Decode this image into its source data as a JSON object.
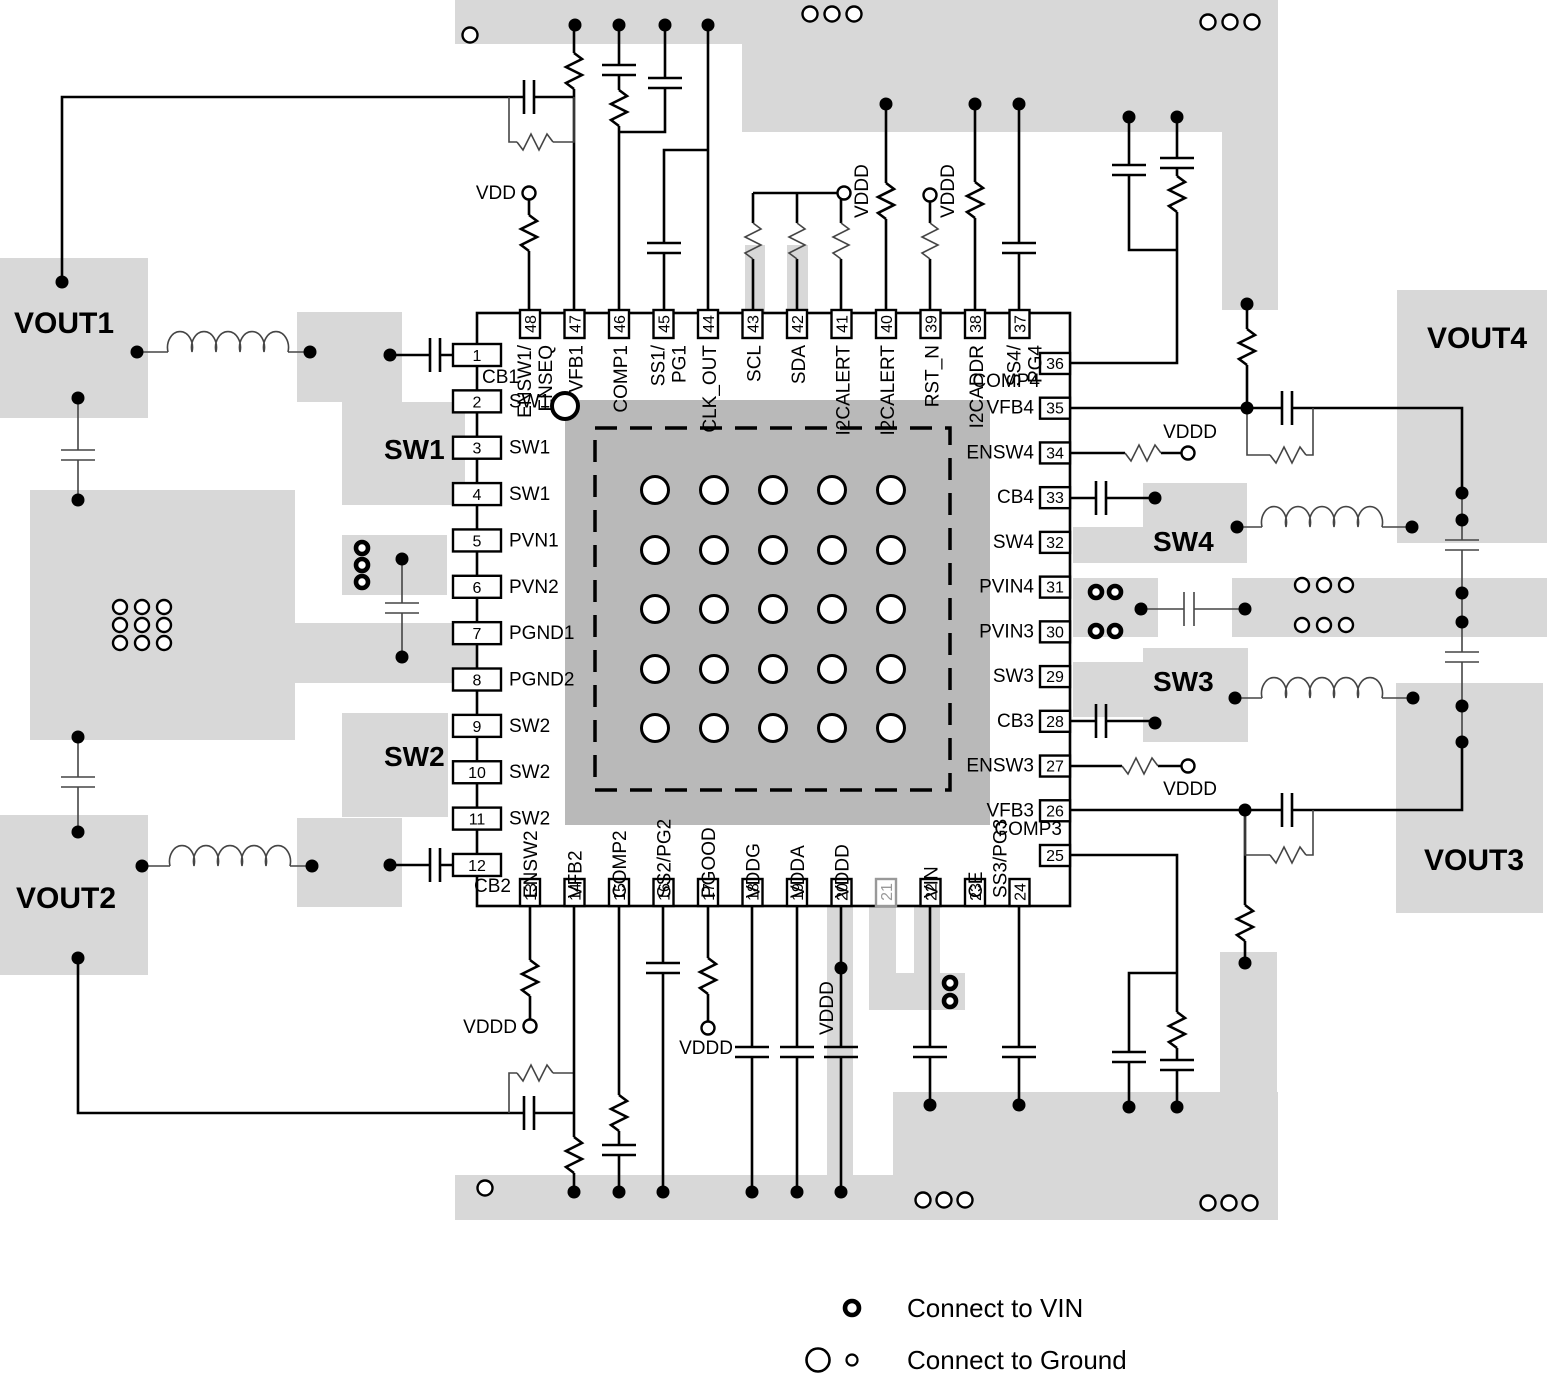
{
  "diagram_title": "PCB layout recommendation for 48-pin quad-output converter",
  "power_labels": {
    "vdd": "VDD",
    "vddd": "VDDD"
  },
  "region_labels": {
    "vout1": "VOUT1",
    "vout2": "VOUT2",
    "vout3": "VOUT3",
    "vout4": "VOUT4",
    "sw1": "SW1",
    "sw2": "SW2",
    "sw3": "SW3",
    "sw4": "SW4"
  },
  "legend": {
    "vin_label": "Connect to VIN",
    "ground_label": "Connect to Ground"
  },
  "chip": {
    "pins": [
      {
        "num": "1",
        "name": "CB1",
        "side": "left"
      },
      {
        "num": "2",
        "name": "SW1",
        "side": "left"
      },
      {
        "num": "3",
        "name": "SW1",
        "side": "left"
      },
      {
        "num": "4",
        "name": "SW1",
        "side": "left"
      },
      {
        "num": "5",
        "name": "PVN1",
        "side": "left"
      },
      {
        "num": "6",
        "name": "PVN2",
        "side": "left"
      },
      {
        "num": "7",
        "name": "PGND1",
        "side": "left"
      },
      {
        "num": "8",
        "name": "PGND2",
        "side": "left"
      },
      {
        "num": "9",
        "name": "SW2",
        "side": "left"
      },
      {
        "num": "10",
        "name": "SW2",
        "side": "left"
      },
      {
        "num": "11",
        "name": "SW2",
        "side": "left"
      },
      {
        "num": "12",
        "name": "CB2",
        "side": "left"
      },
      {
        "num": "13",
        "name": "ENSW2",
        "side": "bottom"
      },
      {
        "num": "14",
        "name": "VFB2",
        "side": "bottom"
      },
      {
        "num": "15",
        "name": "COMP2",
        "side": "bottom"
      },
      {
        "num": "16",
        "name": "SS2/PG2",
        "side": "bottom"
      },
      {
        "num": "17",
        "name": "PGOOD",
        "side": "bottom"
      },
      {
        "num": "18",
        "name": "VDDG",
        "side": "bottom"
      },
      {
        "num": "19",
        "name": "VDDA",
        "side": "bottom"
      },
      {
        "num": "20",
        "name": "VDDD",
        "side": "bottom"
      },
      {
        "num": "21",
        "name": "",
        "side": "bottom",
        "muted": true
      },
      {
        "num": "22",
        "name": "VIN",
        "side": "bottom"
      },
      {
        "num": "23",
        "name": "CE",
        "side": "bottom"
      },
      {
        "num": "24",
        "name": "SS3/PG3",
        "side": "bottom"
      },
      {
        "num": "25",
        "name": "COMP3",
        "side": "right"
      },
      {
        "num": "26",
        "name": "VFB3",
        "side": "right"
      },
      {
        "num": "27",
        "name": "ENSW3",
        "side": "right"
      },
      {
        "num": "28",
        "name": "CB3",
        "side": "right"
      },
      {
        "num": "29",
        "name": "SW3",
        "side": "right"
      },
      {
        "num": "30",
        "name": "PVIN3",
        "side": "right"
      },
      {
        "num": "31",
        "name": "PVIN4",
        "side": "right"
      },
      {
        "num": "32",
        "name": "SW4",
        "side": "right"
      },
      {
        "num": "33",
        "name": "CB4",
        "side": "right"
      },
      {
        "num": "34",
        "name": "ENSW4",
        "side": "right"
      },
      {
        "num": "35",
        "name": "VFB4",
        "side": "right"
      },
      {
        "num": "36",
        "name": "COMP4",
        "side": "right"
      },
      {
        "num": "37",
        "name": "SS4/PG4",
        "side": "top",
        "lines": [
          "SS4/",
          "PG4"
        ]
      },
      {
        "num": "38",
        "name": "I2CADDR",
        "side": "top"
      },
      {
        "num": "39",
        "name": "RST_N",
        "side": "top"
      },
      {
        "num": "40",
        "name": "I2CALERT",
        "side": "top"
      },
      {
        "num": "41",
        "name": "I2CALERT",
        "side": "top"
      },
      {
        "num": "42",
        "name": "SDA",
        "side": "top"
      },
      {
        "num": "43",
        "name": "SCL",
        "side": "top"
      },
      {
        "num": "44",
        "name": "CLK_OUT",
        "side": "top"
      },
      {
        "num": "45",
        "name": "SS1/PG1",
        "side": "top",
        "lines": [
          "SS1/",
          "PG1"
        ]
      },
      {
        "num": "46",
        "name": "COMP1",
        "side": "top"
      },
      {
        "num": "47",
        "name": "VFB1",
        "side": "top"
      },
      {
        "num": "48",
        "name": "ENSW1/ENSEQ",
        "side": "top",
        "lines": [
          "ENSW1/",
          "ENSEQ"
        ]
      }
    ]
  }
}
